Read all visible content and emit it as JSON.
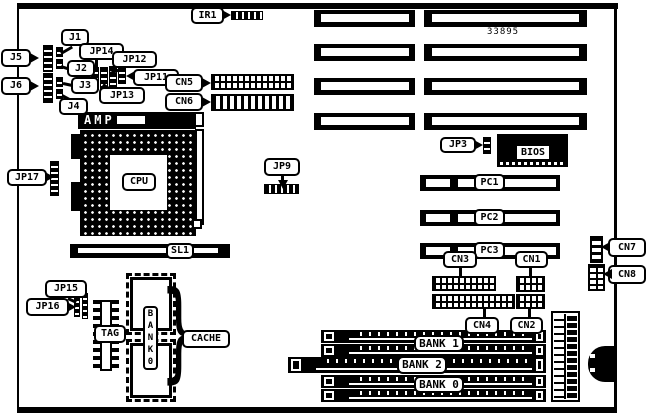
{
  "colors": {
    "ink": "#000000",
    "paper": "#ffffff"
  },
  "board": {
    "part_number": "33895"
  },
  "labels": {
    "ir1": "IR1",
    "j1": "J1",
    "j2": "J2",
    "j3": "J3",
    "j4": "J4",
    "j5": "J5",
    "j6": "J6",
    "jp11": "JP11",
    "jp12": "JP12",
    "jp13": "JP13",
    "jp14": "JP14",
    "jp15": "JP15",
    "jp16": "JP16",
    "jp17": "JP17",
    "jp9": "JP9",
    "jp3": "JP3",
    "cn1": "CN1",
    "cn2": "CN2",
    "cn3": "CN3",
    "cn4": "CN4",
    "cn5": "CN5",
    "cn6": "CN6",
    "cn7": "CN7",
    "cn8": "CN8",
    "amp": "AMP",
    "cpu": "CPU",
    "sl1": "SL1",
    "tag": "TAG",
    "cache": "CACHE",
    "bios": "BIOS",
    "pc1": "PC1",
    "pc2": "PC2",
    "pc3": "PC3",
    "bank1": "BANK 1",
    "bank2": "BANK 2",
    "bank0": "BANK 0",
    "cache_brace": "}"
  },
  "cache_bank_letters": [
    "B",
    "A",
    "N",
    "K",
    "0"
  ]
}
